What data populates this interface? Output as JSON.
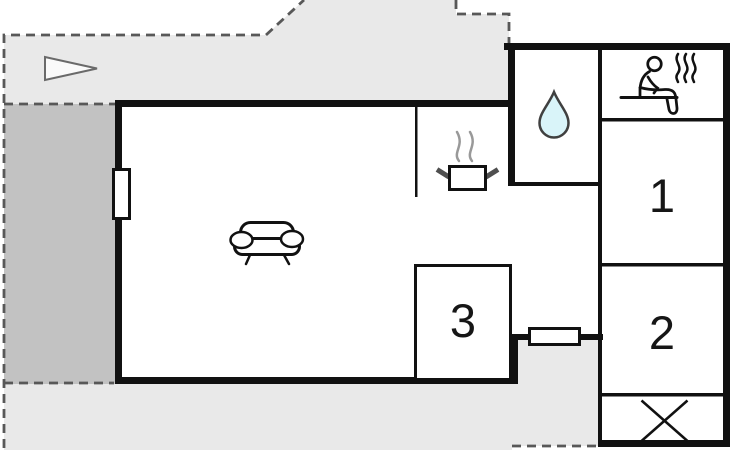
{
  "title": "holiday-home-floor-plan",
  "canvas": {
    "width": 730,
    "height": 450
  },
  "rooms": {
    "room1": {
      "label": "1"
    },
    "room2": {
      "label": "2"
    },
    "room3": {
      "label": "3"
    }
  },
  "icons": {
    "sofa_icon": "sofa-top-view",
    "stove_icon": "cooking-pot-with-steam",
    "water_drop_icon": "water-drop",
    "sauna_icon": "person-in-sauna-with-steam",
    "cross_icon": "diagonal-cross-box",
    "direction_triangle_icon": "triangle-pointer",
    "window_icon": "window-opening"
  },
  "colors": {
    "terrace_light": "#e9e9e9",
    "terrace_dark": "#c2c2c2",
    "wall": "#111111",
    "dashed_outline": "#585858",
    "water_drop_fill": "#d9f4f9",
    "room_fill": "#ffffff",
    "steam_gray": "#999999",
    "handle_gray": "#4f4f4f"
  }
}
